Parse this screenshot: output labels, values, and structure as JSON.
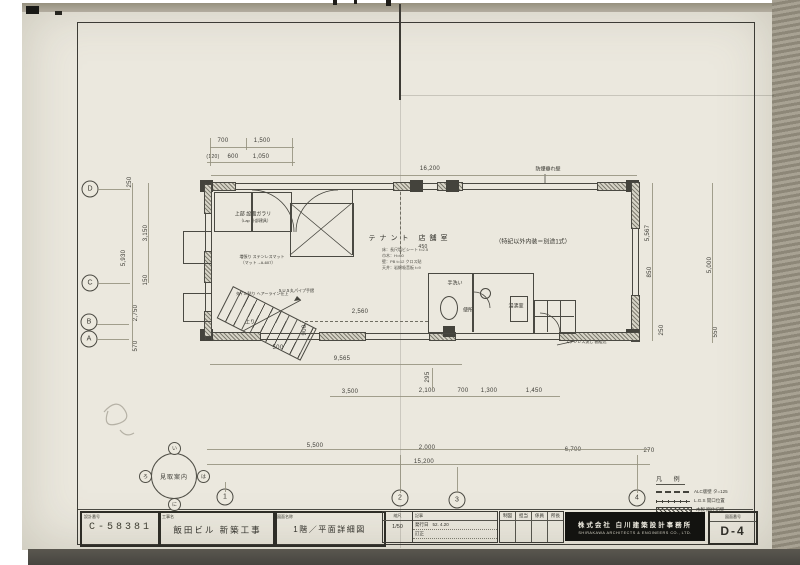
{
  "grid": {
    "bubbles": [
      {
        "t": "D",
        "x": 90,
        "y": 189
      },
      {
        "t": "C",
        "x": 90,
        "y": 283
      },
      {
        "t": "B",
        "x": 89,
        "y": 322
      },
      {
        "t": "A",
        "x": 89,
        "y": 339
      },
      {
        "t": "1",
        "x": 225,
        "y": 497
      },
      {
        "t": "2",
        "x": 400,
        "y": 498
      },
      {
        "t": "3",
        "x": 457,
        "y": 500
      },
      {
        "t": "4",
        "x": 637,
        "y": 498
      }
    ]
  },
  "legend": {
    "title": "凡 例",
    "items": [
      {
        "label": "ALC版壁 タ=125"
      },
      {
        "label": "L.G.S 開口位置"
      },
      {
        "label": "木製 間仕切壁"
      }
    ]
  },
  "compass": {
    "center": "見取案内",
    "satellites": [
      {
        "t": "い"
      },
      {
        "t": "ろ"
      },
      {
        "t": "は"
      },
      {
        "t": "に"
      }
    ]
  },
  "plan": {
    "room_labels": [
      {
        "t": "テナント 店舗室",
        "x": 410,
        "y": 238,
        "fs": 7,
        "ls": 4
      },
      {
        "t": "（特記以外内装＝別途1式）",
        "x": 533,
        "y": 241,
        "fs": 6
      },
      {
        "t": "手洗い",
        "x": 455,
        "y": 283,
        "fs": 5
      },
      {
        "t": "便所",
        "x": 468,
        "y": 310,
        "fs": 5
      },
      {
        "t": "湯沸室",
        "x": 516,
        "y": 306,
        "fs": 5
      },
      {
        "t": "上部 設備ガラリ",
        "x": 253,
        "y": 214,
        "fs": 5
      },
      {
        "t": "（Lap 外部建具）",
        "x": 255,
        "y": 221,
        "fs": 4
      },
      {
        "t": "増張り ステンレスマット",
        "x": 262,
        "y": 257,
        "fs": 4
      },
      {
        "t": "（マット→A-607）",
        "x": 258,
        "y": 263,
        "fs": 4
      },
      {
        "t": "タイル貼り ヘアーライン仕上",
        "x": 262,
        "y": 294,
        "fs": 4
      },
      {
        "t": "ＳＵＳ丸パイプ手摺",
        "x": 296,
        "y": 291,
        "fs": 4
      },
      {
        "t": "防煙垂れ壁",
        "x": 548,
        "y": 169,
        "fs": 5
      },
      {
        "t": "ステンレス流し 棚組込",
        "x": 586,
        "y": 342,
        "fs": 4
      },
      {
        "t": "上り",
        "x": 250,
        "y": 322,
        "fs": 5
      }
    ],
    "notes": [
      {
        "t": "床：長尺塩ビシート t=2.5",
        "x": 382,
        "y": 247
      },
      {
        "t": "巾木：H=60",
        "x": 382,
        "y": 253
      },
      {
        "t": "壁：PB t=12 クロス貼",
        "x": 382,
        "y": 259
      },
      {
        "t": "天井：岩綿吸音板 t=9",
        "x": 382,
        "y": 265
      }
    ],
    "dims": [
      {
        "t": "700",
        "x": 223,
        "y": 141
      },
      {
        "t": "1,500",
        "x": 262,
        "y": 141
      },
      {
        "t": "(120)",
        "x": 213,
        "y": 157,
        "fs": 5
      },
      {
        "t": "600",
        "x": 233,
        "y": 157
      },
      {
        "t": "1,050",
        "x": 261,
        "y": 157
      },
      {
        "t": "16,200",
        "x": 430,
        "y": 169
      },
      {
        "t": "250",
        "x": 130,
        "y": 182,
        "r": 1
      },
      {
        "t": "3,150",
        "x": 146,
        "y": 233,
        "r": 1
      },
      {
        "t": "5,930",
        "x": 124,
        "y": 258,
        "r": 1
      },
      {
        "t": "150",
        "x": 146,
        "y": 280,
        "r": 1
      },
      {
        "t": "2,750",
        "x": 136,
        "y": 313,
        "r": 1
      },
      {
        "t": "570",
        "x": 136,
        "y": 346,
        "r": 1
      },
      {
        "t": "5,567",
        "x": 648,
        "y": 233,
        "r": 1
      },
      {
        "t": "850",
        "x": 650,
        "y": 272,
        "r": 1
      },
      {
        "t": "5,000",
        "x": 710,
        "y": 265,
        "r": 1
      },
      {
        "t": "550",
        "x": 716,
        "y": 332,
        "r": 1
      },
      {
        "t": "250",
        "x": 662,
        "y": 330,
        "r": 1
      },
      {
        "t": "9,565",
        "x": 342,
        "y": 359
      },
      {
        "t": "295",
        "x": 428,
        "y": 377,
        "r": 1
      },
      {
        "t": "2,560",
        "x": 360,
        "y": 312
      },
      {
        "t": "900",
        "x": 305,
        "y": 330,
        "r": 1
      },
      {
        "t": "500",
        "x": 278,
        "y": 348
      },
      {
        "t": "450",
        "x": 423,
        "y": 247,
        "fs": 5
      },
      {
        "t": "3,500",
        "x": 350,
        "y": 392
      },
      {
        "t": "2,100",
        "x": 427,
        "y": 391
      },
      {
        "t": "700",
        "x": 463,
        "y": 391
      },
      {
        "t": "1,300",
        "x": 489,
        "y": 391
      },
      {
        "t": "1,450",
        "x": 534,
        "y": 391
      },
      {
        "t": "5,500",
        "x": 315,
        "y": 446
      },
      {
        "t": "2,000",
        "x": 427,
        "y": 448
      },
      {
        "t": "6,700",
        "x": 573,
        "y": 450
      },
      {
        "t": "270",
        "x": 649,
        "y": 451
      },
      {
        "t": "15,200",
        "x": 424,
        "y": 462
      }
    ]
  },
  "title_block": {
    "design_no_label": "設計番号",
    "design_no": "C-58381",
    "project_label": "工事名",
    "project": "飯田ビル 新築工事",
    "drawing_label": "図面名称",
    "drawing": "1階／平面詳細図",
    "scale_label": "縮尺",
    "scale": "1/50",
    "notes_label": "記事",
    "issue_label": "発行日",
    "issue_date": "52. 4.20",
    "revision_label": "訂正",
    "approval_cols": [
      {
        "t": "制図"
      },
      {
        "t": "担当"
      },
      {
        "t": "係員"
      },
      {
        "t": "所長"
      }
    ],
    "company_jp": "株式会社 白川建築設計事務所",
    "company_en": "SHIRAKAWA ARCHITECTS & ENGINEERS CO., LTD.",
    "dwg_no_label": "図面番号",
    "dwg_no": "D-4"
  }
}
